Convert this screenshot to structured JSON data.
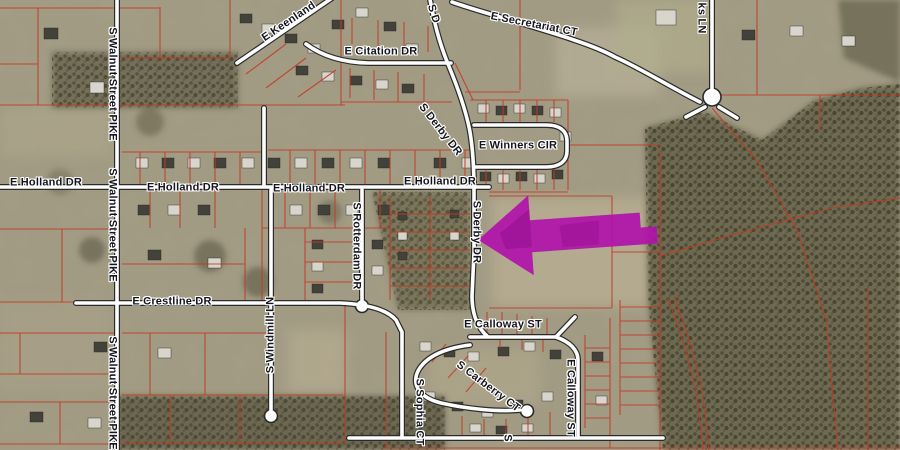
{
  "map": {
    "description": "Aerial parcel map with highlight arrow",
    "labels": {
      "walnut_pike": "S Walnut Street PIKE",
      "holland": "E Holland DR",
      "keenland": "E Keenland",
      "citation": "E Citation DR",
      "secretariat": "E Secretariat CT",
      "derby_abbrev": "S D",
      "derby": "S Derby DR",
      "winners": "E Winners CIR",
      "rotterdam": "S Rotterdam DR",
      "crestline": "E Crestline DR",
      "windmill": "S Windmill LN",
      "calloway": "E Calloway ST",
      "carberry": "S Carberry CT",
      "sophia": "S Sophia CT",
      "ks_ln": "ks LN",
      "s_partial": "S"
    },
    "colors": {
      "parcel_line": "#c13a27",
      "road_fill": "#fdfdfd",
      "road_casing": "#2b2b2b",
      "arrow": "#b013aa",
      "label_text": "#15151f",
      "label_halo": "#ffffff"
    },
    "annotation": {
      "type": "left-pointing-arrow",
      "color_name": "magenta"
    }
  }
}
